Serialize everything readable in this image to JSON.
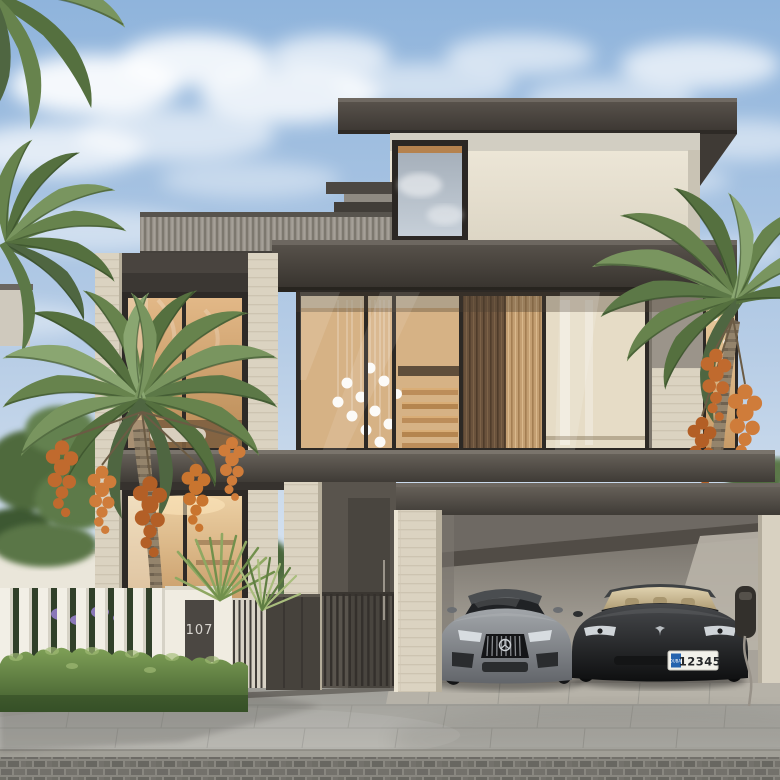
{
  "meta": {
    "description": "Photorealistic 3D exterior rendering of a modern two-storey luxury villa with travertine stone and dark metal facade, floor-to-ceiling glazing with cascading pendant lights, date palms, a white slatted fence with house number 107, trimmed hedges, and a double carport with a grey sports sedan and a black electric sedan (Dubai plate 12345) beside a wall-mounted EV charger.",
    "time_of_day": "daytime",
    "style": "architectural visualization"
  },
  "labels": {
    "house_number": "107",
    "plate_emirate": "DUBAI",
    "plate_number": "12345"
  },
  "scene": {
    "house": {
      "storeys": 2,
      "materials": [
        "travertine stone",
        "dark metal fascia",
        "corrugated metal clerestory",
        "wood slat panels",
        "floor-to-ceiling glass"
      ],
      "features": [
        "flat overhanging roofs",
        "double-height glazed bay with pendant light cascade",
        "interior staircase visible through glass",
        "balcony over carport",
        "vertical-bar entry gate",
        "recessed entry door"
      ]
    },
    "carport": {
      "cars": [
        {
          "label": "grey sports sedan",
          "position": "left bay"
        },
        {
          "label": "black electric sedan",
          "position": "right bay",
          "license_plate": "DUBAI 12345"
        }
      ],
      "ev_charger": "wall-mounted charger with hanging cable"
    },
    "landscape": [
      "date palms with orange date clusters",
      "green garden trees",
      "white slatted boundary fence",
      "trimmed hedge",
      "fan palm shrub",
      "purple flowering shrubs",
      "stone paver sidewalk",
      "cobblestone street edge",
      "drainage channel"
    ],
    "sky": "light blue with soft cumulus clouds"
  },
  "palette": {
    "sky_top": "#8fb4dc",
    "sky_bottom": "#e6edf5",
    "cloud_white": "#ffffff",
    "roof_dark": "#45403b",
    "stucco": "#e9e3d4",
    "travertine": "#dbd3c1",
    "corrugated": "#99948c",
    "wood_slat_light": "#c49f72",
    "wood_slat_dark": "#6a523c",
    "interior_warm": "#d8ad74",
    "glass_cool": "#a7b0ba",
    "hedge_green": "#5d7b42",
    "palm_green": "#67834d",
    "date_orange": "#c9752f",
    "fence_white": "#f0ece1",
    "plaque_dark": "#4b4742",
    "plaque_text": "#d9d6d0",
    "pavement": "#a9a8a2",
    "cobble": "#73716c",
    "car_grey": "#8a8d91",
    "car_black": "#1a1c1e",
    "cabin_tan": "#d6c6a4",
    "plate_bg": "#f2f1ea",
    "plate_blue": "#2563ae",
    "gate_metal": "#3d3935"
  }
}
